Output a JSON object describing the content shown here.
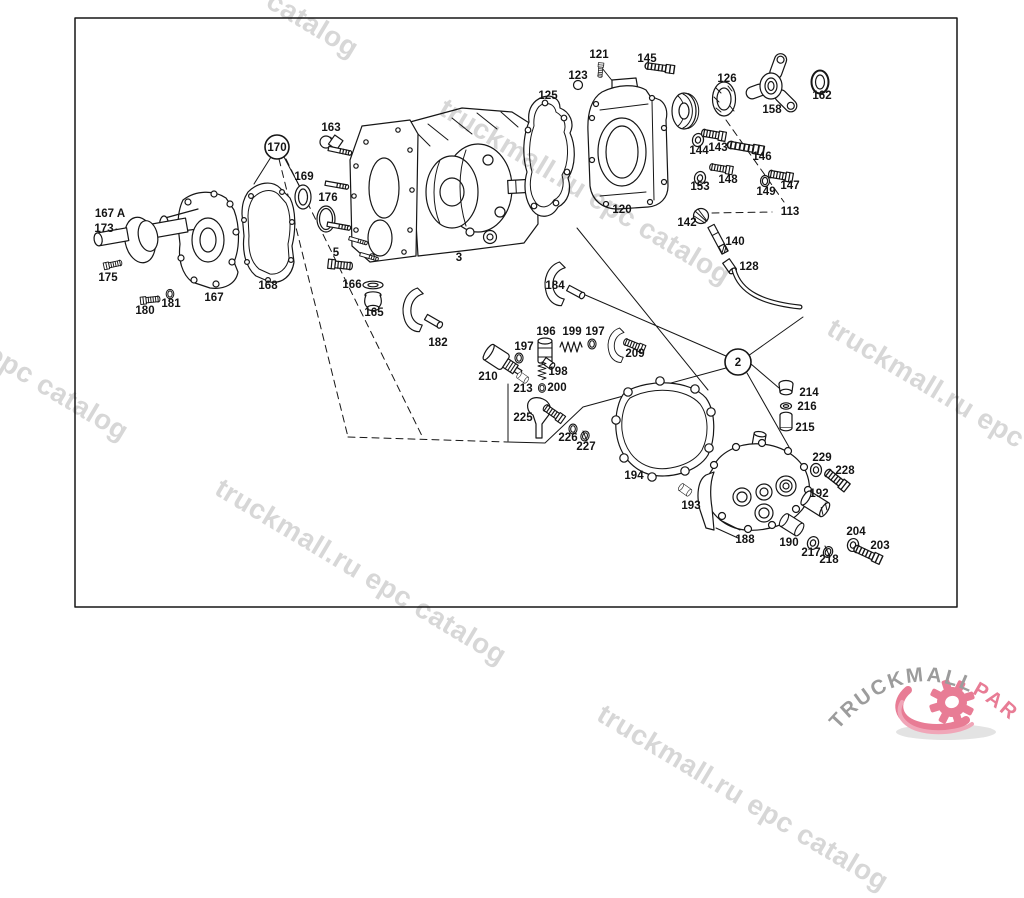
{
  "watermark": {
    "text": "truckmall.ru epc catalog"
  },
  "logo": {
    "brand_gray": "TRUCKMALL",
    "brand_pink": "PARTS",
    "gray_color": "#9c9c9c",
    "pink_color": "#e87c95"
  },
  "diagram": {
    "callouts": [
      {
        "t": "170",
        "x": 277,
        "y": 151,
        "c": true
      },
      {
        "t": "2",
        "x": 738,
        "y": 366,
        "c": true
      }
    ],
    "labels": [
      {
        "t": "167 A",
        "x": 110,
        "y": 217
      },
      {
        "t": "173",
        "x": 104,
        "y": 232
      },
      {
        "t": "175",
        "x": 108,
        "y": 281
      },
      {
        "t": "180",
        "x": 145,
        "y": 314
      },
      {
        "t": "181",
        "x": 171,
        "y": 307
      },
      {
        "t": "167",
        "x": 214,
        "y": 301
      },
      {
        "t": "168",
        "x": 268,
        "y": 289
      },
      {
        "t": "169",
        "x": 304,
        "y": 180
      },
      {
        "t": "176",
        "x": 328,
        "y": 201
      },
      {
        "t": "163",
        "x": 331,
        "y": 131
      },
      {
        "t": "5",
        "x": 336,
        "y": 256
      },
      {
        "t": "166",
        "x": 352,
        "y": 288
      },
      {
        "t": "165",
        "x": 374,
        "y": 316
      },
      {
        "t": "182",
        "x": 438,
        "y": 346
      },
      {
        "t": "3",
        "x": 459,
        "y": 261
      },
      {
        "t": "184",
        "x": 555,
        "y": 289
      },
      {
        "t": "125",
        "x": 548,
        "y": 99
      },
      {
        "t": "123",
        "x": 578,
        "y": 79
      },
      {
        "t": "121",
        "x": 599,
        "y": 58
      },
      {
        "t": "145",
        "x": 647,
        "y": 62
      },
      {
        "t": "120",
        "x": 622,
        "y": 213
      },
      {
        "t": "126",
        "x": 727,
        "y": 82
      },
      {
        "t": "158",
        "x": 772,
        "y": 113
      },
      {
        "t": "162",
        "x": 822,
        "y": 99
      },
      {
        "t": "144",
        "x": 699,
        "y": 154
      },
      {
        "t": "143",
        "x": 718,
        "y": 151
      },
      {
        "t": "146",
        "x": 762,
        "y": 160
      },
      {
        "t": "148",
        "x": 728,
        "y": 183
      },
      {
        "t": "153",
        "x": 700,
        "y": 190
      },
      {
        "t": "149",
        "x": 766,
        "y": 195
      },
      {
        "t": "147",
        "x": 790,
        "y": 189
      },
      {
        "t": "113",
        "x": 790,
        "y": 215
      },
      {
        "t": "142",
        "x": 687,
        "y": 226
      },
      {
        "t": "140",
        "x": 735,
        "y": 245
      },
      {
        "t": "128",
        "x": 749,
        "y": 270
      },
      {
        "t": "196",
        "x": 546,
        "y": 335
      },
      {
        "t": "199",
        "x": 572,
        "y": 335
      },
      {
        "t": "197",
        "x": 595,
        "y": 335
      },
      {
        "t": "197",
        "x": 524,
        "y": 350
      },
      {
        "t": "209",
        "x": 635,
        "y": 357
      },
      {
        "t": "210",
        "x": 488,
        "y": 380
      },
      {
        "t": "198",
        "x": 558,
        "y": 375
      },
      {
        "t": "213",
        "x": 523,
        "y": 392
      },
      {
        "t": "200",
        "x": 557,
        "y": 391
      },
      {
        "t": "225",
        "x": 523,
        "y": 421
      },
      {
        "t": "226",
        "x": 568,
        "y": 441
      },
      {
        "t": "227",
        "x": 586,
        "y": 450
      },
      {
        "t": "194",
        "x": 634,
        "y": 479
      },
      {
        "t": "193",
        "x": 691,
        "y": 509
      },
      {
        "t": "188",
        "x": 745,
        "y": 543
      },
      {
        "t": "190",
        "x": 789,
        "y": 546
      },
      {
        "t": "217",
        "x": 811,
        "y": 556
      },
      {
        "t": "218",
        "x": 829,
        "y": 563
      },
      {
        "t": "204",
        "x": 856,
        "y": 535
      },
      {
        "t": "203",
        "x": 880,
        "y": 549
      },
      {
        "t": "192",
        "x": 819,
        "y": 497
      },
      {
        "t": "229",
        "x": 822,
        "y": 461
      },
      {
        "t": "228",
        "x": 845,
        "y": 474
      },
      {
        "t": "214",
        "x": 809,
        "y": 396
      },
      {
        "t": "216",
        "x": 807,
        "y": 410
      },
      {
        "t": "215",
        "x": 805,
        "y": 431
      }
    ]
  }
}
